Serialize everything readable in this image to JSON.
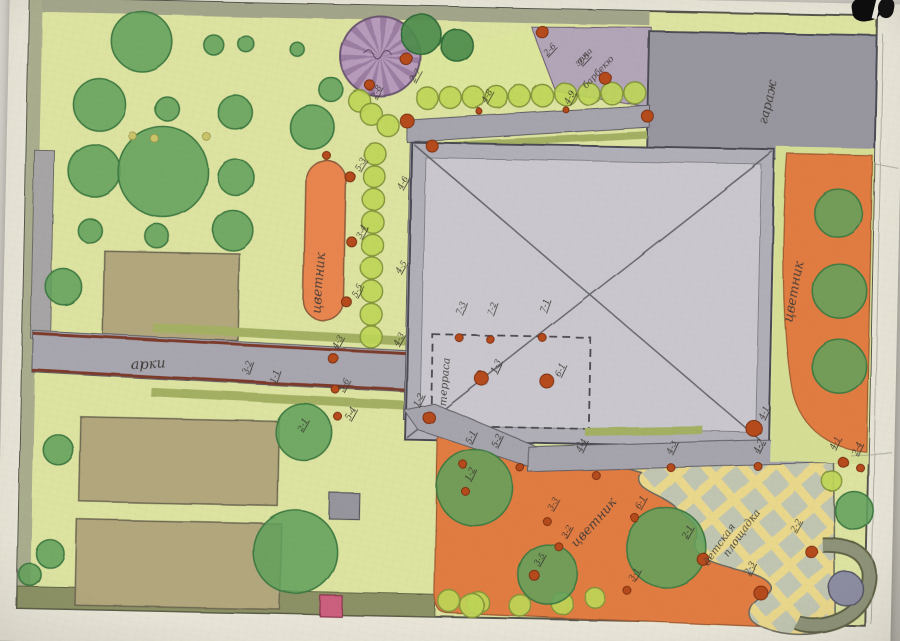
{
  "plan": {
    "labels": {
      "flowerbed_left": "цветник",
      "flowerbed_right": "цветник",
      "flowerbed_bottom": "цветник",
      "terrace": "терраса",
      "garage": "гараж",
      "arch": "арки",
      "barbecue_line1": "зона",
      "barbecue_line2": "барбекю",
      "playground_line1": "детская",
      "playground_line2": "площадка"
    },
    "markers": [
      {
        "text": "2-8",
        "x": 368,
        "y": 106,
        "rot": -62
      },
      {
        "text": "2-7",
        "x": 407,
        "y": 89,
        "rot": -62
      },
      {
        "text": "4-8",
        "x": 479,
        "y": 108,
        "rot": -62
      },
      {
        "text": "4-9",
        "x": 561,
        "y": 107,
        "rot": -62
      },
      {
        "text": "2-6",
        "x": 539,
        "y": 60,
        "rot": -48
      },
      {
        "text": "2-5",
        "x": 573,
        "y": 68,
        "rot": -48
      },
      {
        "text": "5-3",
        "x": 353,
        "y": 178,
        "rot": -62
      },
      {
        "text": "3-4",
        "x": 356,
        "y": 246,
        "rot": -62
      },
      {
        "text": "5-5",
        "x": 353,
        "y": 305,
        "rot": -62
      },
      {
        "text": "4-6",
        "x": 396,
        "y": 196,
        "rot": -62
      },
      {
        "text": "4-5",
        "x": 396,
        "y": 280,
        "rot": -62
      },
      {
        "text": "4-3",
        "x": 395,
        "y": 352,
        "rot": -62
      },
      {
        "text": "4-3",
        "x": 334,
        "y": 356,
        "rot": -62
      },
      {
        "text": "3-2",
        "x": 246,
        "y": 384,
        "rot": -72
      },
      {
        "text": "1-1",
        "x": 273,
        "y": 392,
        "rot": -72
      },
      {
        "text": "5-6",
        "x": 342,
        "y": 400,
        "rot": -62
      },
      {
        "text": "5-4",
        "x": 349,
        "y": 428,
        "rot": -62
      },
      {
        "text": "2-1",
        "x": 301,
        "y": 440,
        "rot": -62
      },
      {
        "text": "1-2",
        "x": 417,
        "y": 413,
        "rot": -66
      },
      {
        "text": "7-3",
        "x": 458,
        "y": 320,
        "rot": -72
      },
      {
        "text": "7-2",
        "x": 489,
        "y": 320,
        "rot": -72
      },
      {
        "text": "7-1",
        "x": 542,
        "y": 316,
        "rot": -72
      },
      {
        "text": "1-3",
        "x": 494,
        "y": 378,
        "rot": -66
      },
      {
        "text": "6-1",
        "x": 558,
        "y": 380,
        "rot": -66
      },
      {
        "text": "4-1",
        "x": 762,
        "y": 418,
        "rot": -66
      },
      {
        "text": "5-1",
        "x": 470,
        "y": 449,
        "rot": -66
      },
      {
        "text": "5-2",
        "x": 496,
        "y": 452,
        "rot": -66
      },
      {
        "text": "4-4",
        "x": 581,
        "y": 455,
        "rot": -66
      },
      {
        "text": "4-3",
        "x": 671,
        "y": 455,
        "rot": -66
      },
      {
        "text": "4-2",
        "x": 758,
        "y": 452,
        "rot": -66
      },
      {
        "text": "4-1",
        "x": 834,
        "y": 447,
        "rot": -66
      },
      {
        "text": "2-4",
        "x": 856,
        "y": 452,
        "rot": -66
      },
      {
        "text": "1-2",
        "x": 470,
        "y": 486,
        "rot": -66
      },
      {
        "text": "3-3",
        "x": 553,
        "y": 514,
        "rot": -62
      },
      {
        "text": "3-2",
        "x": 567,
        "y": 541,
        "rot": -62
      },
      {
        "text": "3-5",
        "x": 540,
        "y": 569,
        "rot": -62
      },
      {
        "text": "3-1",
        "x": 636,
        "y": 583,
        "rot": -62
      },
      {
        "text": "6-1",
        "x": 641,
        "y": 511,
        "rot": -62
      },
      {
        "text": "2-1",
        "x": 688,
        "y": 539,
        "rot": -62
      },
      {
        "text": "2-2",
        "x": 796,
        "y": 530,
        "rot": -62
      },
      {
        "text": "2-3",
        "x": 751,
        "y": 574,
        "rot": -62
      }
    ],
    "colors": {
      "lawn": "#dce2a0",
      "path_gray": "#a5a3ac",
      "house_wall": "#b0aeb7",
      "house_floor": "#c9c7cd",
      "garage": "#97959e",
      "flowerbed_orange": "#e07b42",
      "playground_yellow": "#e9d78b",
      "playground_diamond": "#b5c1ba",
      "purple_tree": "#b69bba",
      "barbecue_zone": "#b2a5b8",
      "plant_dot": "#b54b1e",
      "veg_bed": "#b2a77b",
      "pond": "#8d8da2",
      "pink_square": "#cb5f7e",
      "hedge": "#bdd557",
      "tree": "#63a05c",
      "path_edge_red": "#7c3b2c",
      "green_strip": "#a3b064"
    },
    "geometry": {
      "trees": [
        {
          "x": 133,
          "y": 53,
          "r": 30
        },
        {
          "x": 92,
          "y": 117,
          "r": 26
        },
        {
          "x": 160,
          "y": 120,
          "r": 12
        },
        {
          "x": 228,
          "y": 122,
          "r": 17
        },
        {
          "x": 205,
          "y": 55,
          "r": 10
        },
        {
          "x": 237,
          "y": 53,
          "r": 8
        },
        {
          "x": 288,
          "y": 57,
          "r": 7
        },
        {
          "x": 323,
          "y": 97,
          "r": 12
        },
        {
          "x": 88,
          "y": 183,
          "r": 26
        },
        {
          "x": 157,
          "y": 183,
          "r": 45
        },
        {
          "x": 230,
          "y": 187,
          "r": 18
        },
        {
          "x": 228,
          "y": 240,
          "r": 20
        },
        {
          "x": 85,
          "y": 243,
          "r": 12
        },
        {
          "x": 152,
          "y": 247,
          "r": 12
        },
        {
          "x": 60,
          "y": 300,
          "r": 18
        },
        {
          "x": 305,
          "y": 135,
          "r": 22
        },
        {
          "x": 412,
          "y": 40,
          "r": 20,
          "v": "d"
        },
        {
          "x": 448,
          "y": 50,
          "r": 16,
          "v": "d"
        },
        {
          "x": 58,
          "y": 463,
          "r": 15
        },
        {
          "x": 52,
          "y": 567,
          "r": 14
        },
        {
          "x": 303,
          "y": 440,
          "r": 28
        },
        {
          "x": 297,
          "y": 560,
          "r": 42
        },
        {
          "x": 32,
          "y": 588,
          "r": 11
        },
        {
          "x": 833,
          "y": 210,
          "r": 24
        },
        {
          "x": 836,
          "y": 288,
          "r": 27
        },
        {
          "x": 837,
          "y": 363,
          "r": 27
        },
        {
          "x": 475,
          "y": 492,
          "r": 38
        },
        {
          "x": 550,
          "y": 577,
          "r": 30
        },
        {
          "x": 668,
          "y": 548,
          "r": 40
        },
        {
          "x": 855,
          "y": 507,
          "r": 19
        }
      ],
      "hedge_bushes": [
        {
          "x": 368,
          "y": 160
        },
        {
          "x": 368,
          "y": 183
        },
        {
          "x": 368,
          "y": 206
        },
        {
          "x": 368,
          "y": 229
        },
        {
          "x": 368,
          "y": 252
        },
        {
          "x": 368,
          "y": 275
        },
        {
          "x": 368,
          "y": 298
        },
        {
          "x": 368,
          "y": 321
        },
        {
          "x": 368,
          "y": 343
        },
        {
          "x": 352,
          "y": 108
        },
        {
          "x": 364,
          "y": 121
        },
        {
          "x": 381,
          "y": 132
        },
        {
          "x": 420,
          "y": 104
        },
        {
          "x": 443,
          "y": 103
        },
        {
          "x": 466,
          "y": 102
        },
        {
          "x": 489,
          "y": 101
        },
        {
          "x": 512,
          "y": 100
        },
        {
          "x": 535,
          "y": 99
        },
        {
          "x": 558,
          "y": 97
        },
        {
          "x": 581,
          "y": 96
        },
        {
          "x": 604,
          "y": 95
        },
        {
          "x": 627,
          "y": 94
        },
        {
          "x": 452,
          "y": 606
        },
        {
          "x": 481,
          "y": 607
        },
        {
          "x": 523,
          "y": 609
        },
        {
          "x": 565,
          "y": 606
        },
        {
          "x": 598,
          "y": 600,
          "r": 10
        },
        {
          "x": 832,
          "y": 478,
          "r": 10
        },
        {
          "x": 475,
          "y": 610,
          "r": 12
        }
      ],
      "plant_dots": [
        {
          "x": 398,
          "y": 65,
          "r": 6
        },
        {
          "x": 362,
          "y": 92,
          "r": 5
        },
        {
          "x": 533,
          "y": 35,
          "r": 6
        },
        {
          "x": 597,
          "y": 80,
          "r": 6
        },
        {
          "x": 400,
          "y": 127,
          "r": 7
        },
        {
          "x": 425,
          "y": 151,
          "r": 6
        },
        {
          "x": 640,
          "y": 117,
          "r": 6
        },
        {
          "x": 320,
          "y": 163,
          "r": 4
        },
        {
          "x": 344,
          "y": 184,
          "r": 5
        },
        {
          "x": 347,
          "y": 249,
          "r": 5
        },
        {
          "x": 343,
          "y": 309,
          "r": 5
        },
        {
          "x": 331,
          "y": 366,
          "r": 5
        },
        {
          "x": 334,
          "y": 397,
          "r": 4
        },
        {
          "x": 337,
          "y": 424,
          "r": 4
        },
        {
          "x": 428,
          "y": 423,
          "r": 6
        },
        {
          "x": 457,
          "y": 343,
          "r": 4
        },
        {
          "x": 488,
          "y": 344,
          "r": 4
        },
        {
          "x": 540,
          "y": 341,
          "r": 4
        },
        {
          "x": 480,
          "y": 383,
          "r": 7
        },
        {
          "x": 545,
          "y": 384,
          "r": 7
        },
        {
          "x": 753,
          "y": 427,
          "r": 8
        },
        {
          "x": 463,
          "y": 469,
          "r": 4
        },
        {
          "x": 520,
          "y": 471,
          "r": 4
        },
        {
          "x": 596,
          "y": 477,
          "r": 4
        },
        {
          "x": 671,
          "y": 468,
          "r": 4
        },
        {
          "x": 758,
          "y": 465,
          "r": 4
        },
        {
          "x": 843,
          "y": 459,
          "r": 5
        },
        {
          "x": 860,
          "y": 464,
          "r": 4
        },
        {
          "x": 548,
          "y": 524,
          "r": 4
        },
        {
          "x": 560,
          "y": 549,
          "r": 4
        },
        {
          "x": 536,
          "y": 578,
          "r": 5
        },
        {
          "x": 630,
          "y": 592,
          "r": 4
        },
        {
          "x": 636,
          "y": 519,
          "r": 4
        },
        {
          "x": 466,
          "y": 496,
          "r": 4
        },
        {
          "x": 705,
          "y": 559,
          "r": 6
        },
        {
          "x": 763,
          "y": 591,
          "r": 7
        },
        {
          "x": 813,
          "y": 549,
          "r": 6
        },
        {
          "x": 472,
          "y": 116,
          "r": 3
        },
        {
          "x": 558,
          "y": 112,
          "r": 3
        }
      ],
      "accent_dots": [
        {
          "x": 126,
          "y": 148
        },
        {
          "x": 148,
          "y": 150
        },
        {
          "x": 200,
          "y": 147
        }
      ]
    }
  }
}
